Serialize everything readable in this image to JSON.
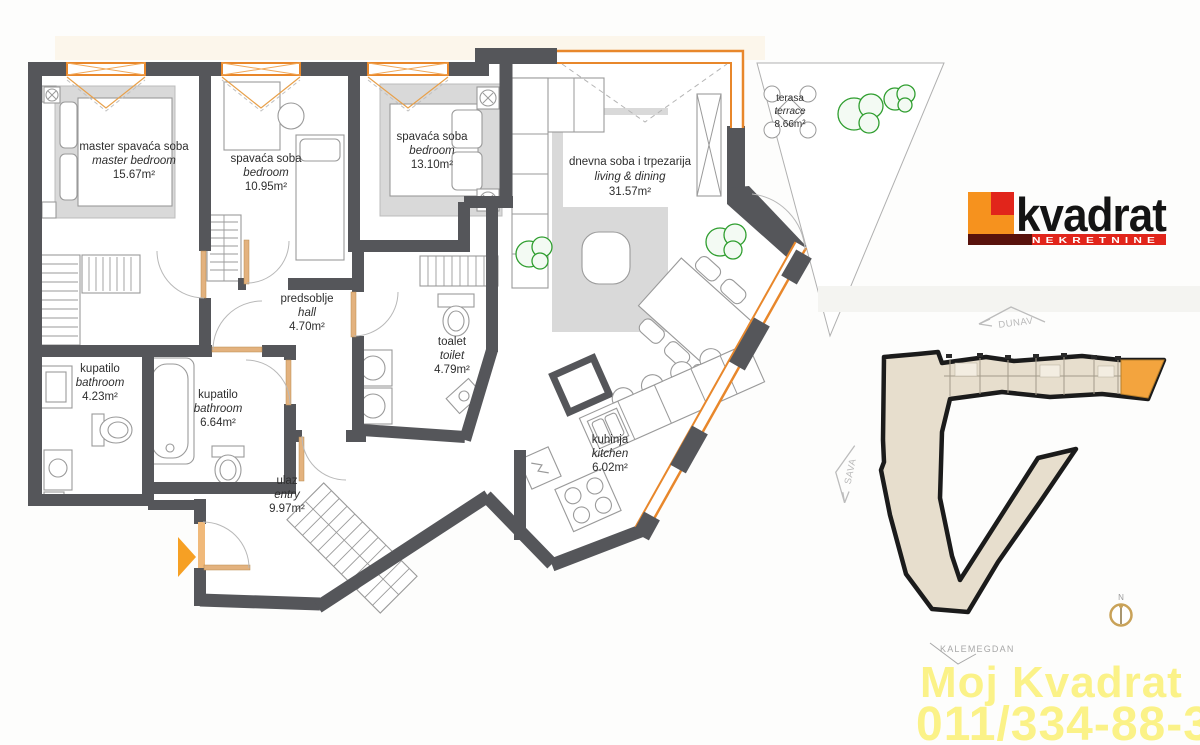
{
  "plan": {
    "rooms": {
      "master_bedroom": {
        "name_sr": "master spavaća soba",
        "name_en": "master bedroom",
        "area": "15.67m²"
      },
      "bedroom_2": {
        "name_sr": "spavaća soba",
        "name_en": "bedroom",
        "area": "10.95m²"
      },
      "bedroom_3": {
        "name_sr": "spavaća soba",
        "name_en": "bedroom",
        "area": "13.10m²"
      },
      "living_dining": {
        "name_sr": "dnevna soba i trpezarija",
        "name_en": "living & dining",
        "area": "31.57m²"
      },
      "terrace": {
        "name_sr": "terasa",
        "name_en": "terrace",
        "area": "8.66m²"
      },
      "hall": {
        "name_sr": "predsoblje",
        "name_en": "hall",
        "area": "4.70m²"
      },
      "toilet": {
        "name_sr": "toalet",
        "name_en": "toilet",
        "area": "4.79m²"
      },
      "bathroom_1": {
        "name_sr": "kupatilo",
        "name_en": "bathroom",
        "area": "4.23m²"
      },
      "bathroom_2": {
        "name_sr": "kupatilo",
        "name_en": "bathroom",
        "area": "6.64m²"
      },
      "entry": {
        "name_sr": "ulaz",
        "name_en": "entry",
        "area": "9.97m²"
      },
      "kitchen": {
        "name_sr": "kuhinja",
        "name_en": "kitchen",
        "area": "6.02m²"
      }
    }
  },
  "site_map": {
    "river_top": "DUNAV",
    "river_left": "SAVA",
    "landmark": "KALEMEGDAN",
    "compass_north": "N"
  },
  "branding": {
    "logo_text": "kvadrat",
    "logo_subtext": "NEKRETNINE"
  },
  "watermark": {
    "line1": "Moj Kvadrat",
    "line2": "011/334-88-36"
  },
  "colors": {
    "wall": "#55565a",
    "window_orange": "#e8872b",
    "accent_orange": "#f6a024",
    "site_building": "#e7decd",
    "site_highlight": "#f3a43e",
    "logo_orange": "#f6921e",
    "logo_red": "#e1251b",
    "watermark_yellow": "#fbf282",
    "plant_green": "#2f9e2f"
  }
}
